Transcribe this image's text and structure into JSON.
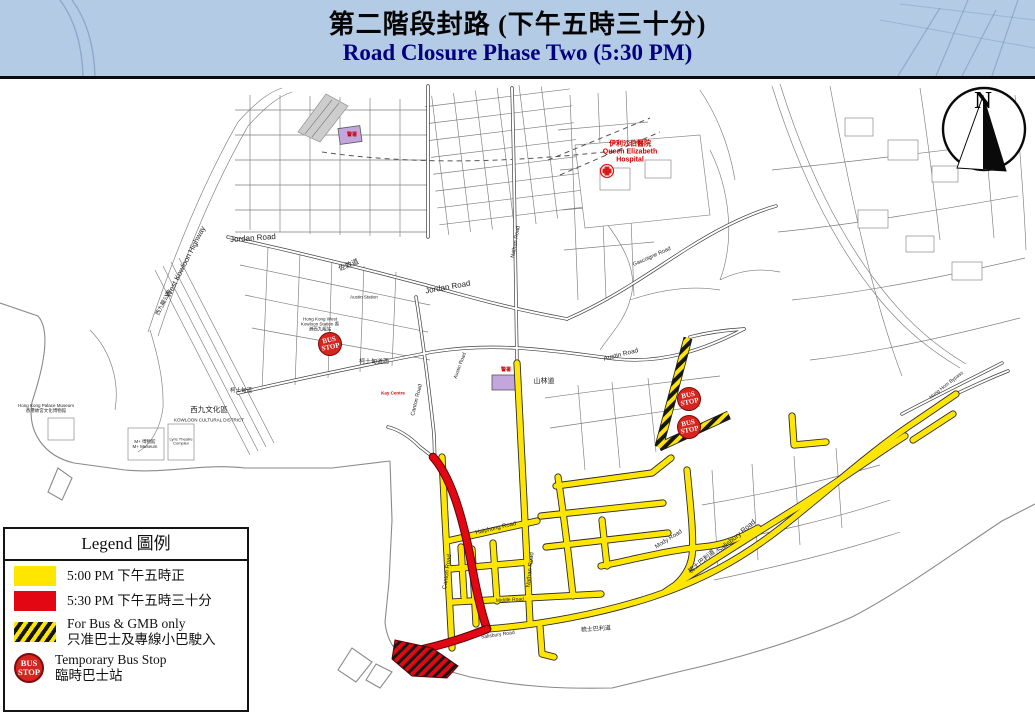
{
  "title": {
    "line1_zh": "第二階段封路 (下午五時三十分)",
    "line2_en": "Road Closure Phase Two (5:30 PM)"
  },
  "colors": {
    "title_bg": "#b3cbe4",
    "phase1_yellow": "#ffe600",
    "phase2_red": "#e30613",
    "bus_stop_red": "#d6251f",
    "label_red": "#cc0000",
    "building_purple": "#c3a6dd"
  },
  "legend": {
    "title": "Legend 圖例",
    "rows": [
      {
        "key": "phase1-500pm",
        "label": "5:00 PM 下午五時正"
      },
      {
        "key": "phase2-530pm",
        "label": "5:30 PM 下午五時三十分"
      },
      {
        "key": "bus-gmb-only",
        "label_en": "For Bus & GMB only",
        "label_zh": "只准巴士及專線小巴駛入"
      },
      {
        "key": "temporary-bus-stop",
        "label_en": "Temporary Bus Stop",
        "label_zh": "臨時巴士站"
      }
    ]
  },
  "compass": {
    "label": "N"
  },
  "bus_stop": {
    "line1": "BUS",
    "line2": "STOP"
  },
  "map": {
    "bus_stops": [
      {
        "x": 330,
        "y": 344
      },
      {
        "x": 689,
        "y": 399
      },
      {
        "x": 689,
        "y": 427
      }
    ],
    "labels": [
      {
        "t": "Jordan Road",
        "x": 253,
        "y": 239,
        "r": -4,
        "s": 8
      },
      {
        "t": "Jordan Road",
        "x": 448,
        "y": 288,
        "r": -10,
        "s": 8
      },
      {
        "t": "佐敦道",
        "x": 349,
        "y": 266,
        "r": -22,
        "s": 7
      },
      {
        "t": "West Kowloon Highway",
        "x": 186,
        "y": 262,
        "r": -63,
        "s": 7.5
      },
      {
        "t": "西九龍公路",
        "x": 164,
        "y": 303,
        "r": -63,
        "s": 5.5
      },
      {
        "t": "Austin Station",
        "x": 364,
        "y": 297,
        "r": 0,
        "s": 4.5
      },
      {
        "t": "Hong Kong West Kowloon Station 香港西九龍站",
        "x": 320,
        "y": 324,
        "r": 0,
        "s": 4.5,
        "w": 42
      },
      {
        "t": "柯士甸道西",
        "x": 374,
        "y": 363,
        "r": 0,
        "s": 6
      },
      {
        "t": "柯士甸道",
        "x": 241,
        "y": 391,
        "r": 0,
        "s": 5.5
      },
      {
        "t": "Austin Road",
        "x": 621,
        "y": 355,
        "r": -14,
        "s": 6.5
      },
      {
        "t": "Austin Road",
        "x": 461,
        "y": 366,
        "r": -70,
        "s": 5
      },
      {
        "t": "山林道",
        "x": 544,
        "y": 382,
        "r": 0,
        "s": 7
      },
      {
        "t": "Canton Road",
        "x": 417,
        "y": 400,
        "r": -76,
        "s": 5.5
      },
      {
        "t": "Canton Road",
        "x": 448,
        "y": 572,
        "r": -82,
        "s": 6
      },
      {
        "t": "Nathan Road",
        "x": 531,
        "y": 570,
        "r": -84,
        "s": 6
      },
      {
        "t": "Nathan Road",
        "x": 516,
        "y": 242,
        "r": -80,
        "s": 5.5
      },
      {
        "t": "Haiphong Road",
        "x": 496,
        "y": 529,
        "r": -13,
        "s": 6
      },
      {
        "t": "Salisbury Road",
        "x": 737,
        "y": 537,
        "r": -40,
        "s": 7
      },
      {
        "t": "梳士巴利道",
        "x": 702,
        "y": 562,
        "r": -40,
        "s": 6.5
      },
      {
        "t": "Salisbury Road",
        "x": 498,
        "y": 636,
        "r": -8,
        "s": 5
      },
      {
        "t": "梳士巴利道",
        "x": 596,
        "y": 630,
        "r": -4,
        "s": 6
      },
      {
        "t": "Middle Road",
        "x": 510,
        "y": 601,
        "r": -3,
        "s": 5
      },
      {
        "t": "Mody Road",
        "x": 669,
        "y": 540,
        "r": -32,
        "s": 6
      },
      {
        "t": "Gascoigne Road",
        "x": 652,
        "y": 257,
        "r": -24,
        "s": 5.5
      },
      {
        "t": "Hung Hom Bypass",
        "x": 947,
        "y": 386,
        "r": -38,
        "s": 5
      },
      {
        "t": "Hong Kong Palace Museum\n香港故宮文化博物館",
        "x": 46,
        "y": 408,
        "r": 0,
        "s": 4.5,
        "w": 64
      },
      {
        "t": "西九文化區",
        "x": 209,
        "y": 410,
        "r": 0,
        "s": 7.5
      },
      {
        "t": "KOWLOON CULTURAL DISTRICT",
        "x": 209,
        "y": 420,
        "r": 0,
        "s": 4.5
      },
      {
        "t": "M+ 博物館\nM+ Museum",
        "x": 145,
        "y": 444,
        "r": 0,
        "s": 4.5,
        "w": 40
      },
      {
        "t": "Lyric Theatre Complex",
        "x": 181,
        "y": 442,
        "r": 0,
        "s": 4,
        "w": 34
      },
      {
        "t": "伊利沙伯醫院\nQueen Elizabeth\nHospital",
        "x": 630,
        "y": 152,
        "r": 0,
        "s": 7,
        "c": "red",
        "w": 84
      },
      {
        "t": "Kay Centre",
        "x": 393,
        "y": 393,
        "r": 0,
        "s": 4.5,
        "c": "red",
        "w": 32
      },
      {
        "t": "警署",
        "x": 352,
        "y": 136,
        "r": 0,
        "s": 5,
        "c": "red"
      },
      {
        "t": "警署",
        "x": 506,
        "y": 371,
        "r": 0,
        "s": 5,
        "c": "red"
      }
    ]
  }
}
